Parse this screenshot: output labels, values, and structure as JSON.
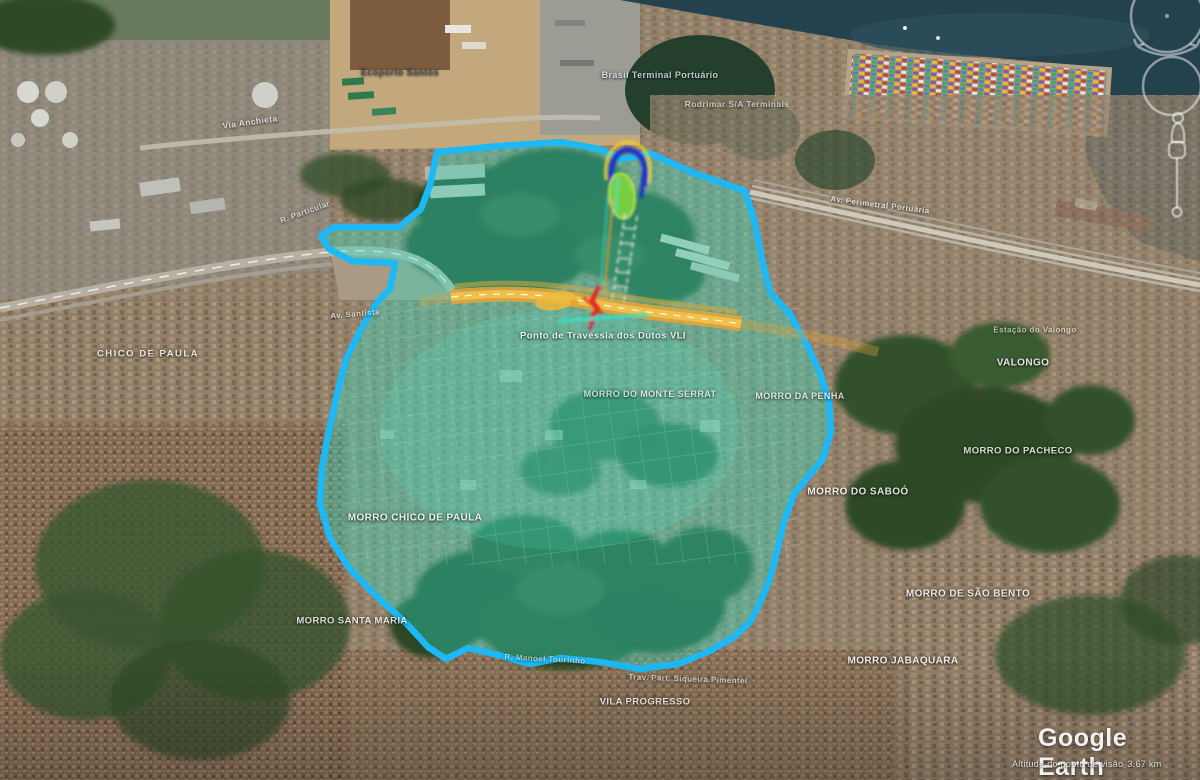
{
  "app": {
    "name": "Google Earth",
    "watermark": "Google Earth",
    "status": {
      "eye_altitude_label": "Altitude do ponto de visão",
      "eye_altitude_value": "3.67 km"
    }
  },
  "theme": {
    "aoi-fill": "rgba(47,224,196,0.38)",
    "aoi-stroke": "#1db8f5",
    "road-highlight": "#e2a438",
    "road-highlight-core": "#f2c44e",
    "route-blue": "#2336c8",
    "route-yellow": "#f2d02a",
    "route-green": "#8ce03c",
    "route-red": "#e02828",
    "route-cyan": "#38e0c4",
    "water": "#24424d"
  },
  "map": {
    "imagery": "satellite",
    "aoi": {
      "name": "study-area-polygon",
      "outline_color": "#1db8f5"
    },
    "nav": {
      "controls": [
        "compass",
        "look-joystick",
        "pegman",
        "zoom-slider"
      ]
    },
    "labels": [
      {
        "text": "Ecoporto Santos",
        "x": 400,
        "y": 72,
        "size": 9,
        "rot": 0,
        "op": 0.8,
        "color": "#3a4250"
      },
      {
        "text": "Brasil Terminal Portuário",
        "x": 660,
        "y": 75,
        "size": 9,
        "rot": 0,
        "op": 0.8,
        "color": "#dfe8f2"
      },
      {
        "text": "Rodrimar S/A Terminais",
        "x": 737,
        "y": 104,
        "size": 8.5,
        "rot": 0,
        "op": 0.6
      },
      {
        "text": "Av. Perimetral Portuária",
        "x": 880,
        "y": 205,
        "size": 8,
        "rot": 7,
        "op": 0.7
      },
      {
        "text": "Via Anchieta",
        "x": 250,
        "y": 122,
        "size": 8.5,
        "rot": -8,
        "op": 0.7
      },
      {
        "text": "R. Particular",
        "x": 305,
        "y": 212,
        "size": 8,
        "rot": -20,
        "op": 0.6
      },
      {
        "text": "Av. Santista",
        "x": 355,
        "y": 314,
        "size": 8,
        "rot": -5,
        "op": 0.65
      },
      {
        "text": "CHICO DE PAULA",
        "x": 148,
        "y": 354,
        "size": 9.5,
        "rot": 0,
        "op": 0.8,
        "spacing": 1.5
      },
      {
        "text": "Estação do Valongo",
        "x": 1035,
        "y": 330,
        "size": 8,
        "rot": 0,
        "op": 0.6
      },
      {
        "text": "VALONGO",
        "x": 1023,
        "y": 363,
        "size": 10,
        "rot": 0,
        "op": 0.85
      },
      {
        "text": "Ponto de Travessia dos Dutos VLI",
        "x": 603,
        "y": 336,
        "size": 9.5,
        "rot": 0,
        "op": 0.85
      },
      {
        "text": "MORRO DO MONTE SERRAT",
        "x": 650,
        "y": 394,
        "size": 9,
        "rot": 0,
        "op": 0.7
      },
      {
        "text": "MORRO DA PENHA",
        "x": 800,
        "y": 396,
        "size": 9,
        "rot": 0,
        "op": 0.75
      },
      {
        "text": "MORRO DO PACHECO",
        "x": 1018,
        "y": 451,
        "size": 9.5,
        "rot": 0,
        "op": 0.8
      },
      {
        "text": "MORRO DO SABOÓ",
        "x": 858,
        "y": 492,
        "size": 10,
        "rot": 0,
        "op": 0.85
      },
      {
        "text": "MORRO CHICO DE PAULA",
        "x": 415,
        "y": 518,
        "size": 10,
        "rot": 0,
        "op": 0.85
      },
      {
        "text": "MORRO DE SÃO BENTO",
        "x": 968,
        "y": 594,
        "size": 10,
        "rot": 0,
        "op": 0.8
      },
      {
        "text": "MORRO SANTA MARIA",
        "x": 352,
        "y": 621,
        "size": 9.5,
        "rot": 0,
        "op": 0.8
      },
      {
        "text": "MORRO JABAQUARA",
        "x": 903,
        "y": 661,
        "size": 10,
        "rot": 0,
        "op": 0.85
      },
      {
        "text": "R. Manoel Tourinho",
        "x": 545,
        "y": 659,
        "size": 8,
        "rot": 3,
        "op": 0.55
      },
      {
        "text": "Trav. Part. Siqueira Pimentel",
        "x": 688,
        "y": 679,
        "size": 8,
        "rot": 2,
        "op": 0.6
      },
      {
        "text": "VILA PROGRESSO",
        "x": 645,
        "y": 702,
        "size": 9.5,
        "rot": 0,
        "op": 0.75
      }
    ]
  }
}
